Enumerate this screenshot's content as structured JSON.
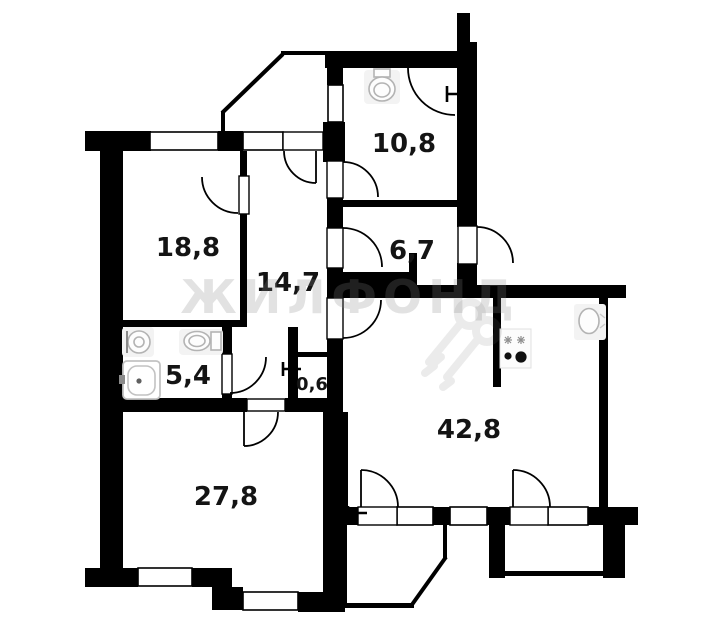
{
  "plan": {
    "title": "apartment-floor-plan",
    "rooms": [
      {
        "id": "room-18-8",
        "area": "18,8"
      },
      {
        "id": "hall-14-7",
        "area": "14,7"
      },
      {
        "id": "wc-10-8",
        "area": "10,8"
      },
      {
        "id": "room-6-7",
        "area": "6,7"
      },
      {
        "id": "bathroom-5-4",
        "area": "5,4"
      },
      {
        "id": "closet-0-6",
        "area": "0,6"
      },
      {
        "id": "room-27-8",
        "area": "27,8"
      },
      {
        "id": "kitchen-living-42-8",
        "area": "42,8"
      }
    ],
    "watermark": "ЖИЛФОНД",
    "icons": [
      "toilet-icon",
      "toilet-icon-2",
      "sink-icon",
      "bathtub-icon",
      "stove-icon",
      "kitchen-sink-icon",
      "radiator-icon-1",
      "radiator-icon-2",
      "radiator-icon-3",
      "keys-watermark-icon"
    ],
    "colors": {
      "wall": "#000000",
      "background": "#ffffff",
      "watermark": "#888888",
      "fixture_outline": "#b3b3b3"
    }
  }
}
